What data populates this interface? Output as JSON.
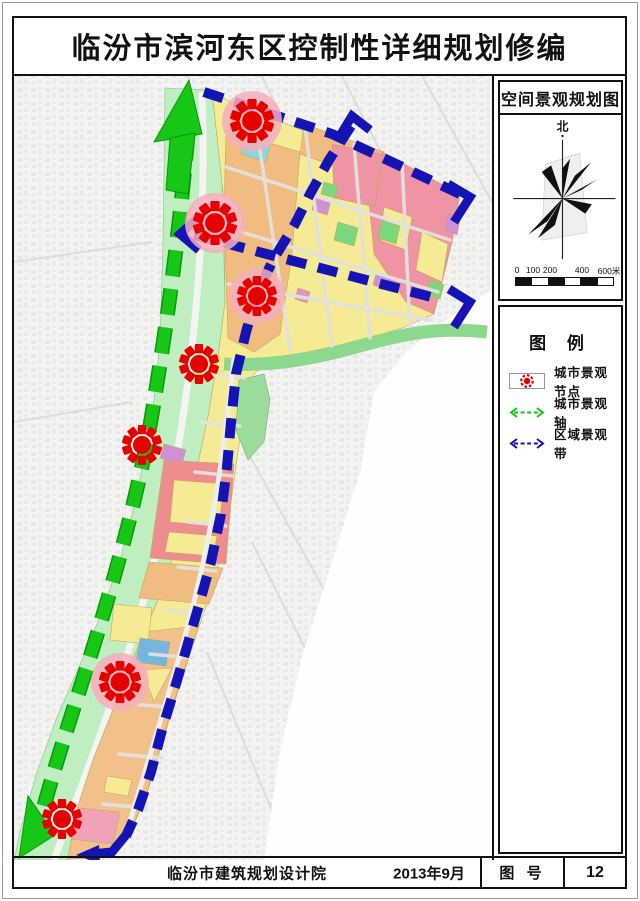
{
  "title": "临汾市滨河东区控制性详细规划修编",
  "panel": {
    "map_title": "空间景观规划图",
    "compass_label": "北",
    "scale_labels": [
      "0",
      "100",
      "200",
      "400",
      "600米"
    ],
    "legend": {
      "title": "图 例",
      "items": [
        {
          "label": "城市景观节点",
          "type": "node-icon",
          "color": "#e60000"
        },
        {
          "label": "城市景观轴",
          "type": "axis-icon",
          "color": "#16c716"
        },
        {
          "label": "区域景观带",
          "type": "belt-icon",
          "color": "#1414b4"
        }
      ]
    }
  },
  "footer": {
    "institute": "临汾市建筑规划设计院",
    "date": "2013年9月",
    "sheet_label": "图 号",
    "sheet_number": "12"
  },
  "map": {
    "axis": {
      "name": "城市景观轴",
      "color": "#16c716",
      "outline": "#0a970a",
      "path": "M186,132 C176,240 168,300 152,400 C138,488 112,580 84,668 C62,736 48,780 38,820",
      "arrow_head_top": "187,78 152,140 200,132",
      "arrow_body_top": "168,136 193,131 186,192 164,188",
      "arrow_head_bottom": "17,856 53,833 26,794"
    },
    "belt_color": "#1414b4",
    "belts": [
      {
        "name": "north-belt",
        "path": "M202,90 L330,132 L458,192",
        "ends": [
          "M336,137 L350,114 L368,128",
          "M446,182 L468,195 L452,220"
        ]
      },
      {
        "name": "east-belt",
        "path": "M349,124 L327,158 L308,192 L293,222 L271,258 L255,292 L244,330 L234,372 L229,420 L225,465 L219,512 L209,560 L197,603 L184,648 L171,692 L160,728 L149,770 L136,808 L124,834",
        "ends": [
          "M124,833 L110,850 L90,852"
        ],
        "tips": [
          "97,843 74,853 98,862"
        ]
      },
      {
        "name": "middle-belt",
        "path": "M192,233 L437,297",
        "ends": [
          "M196,216 L178,232 L197,248",
          "M447,287 L468,300 L452,325"
        ]
      }
    ],
    "nodes": {
      "name": "城市景观节点",
      "color": "#e60000",
      "halo_color": "#f4aebc",
      "points": [
        {
          "x": 250,
          "y": 119,
          "r": 22,
          "halo": true
        },
        {
          "x": 213,
          "y": 221,
          "r": 22,
          "halo": true
        },
        {
          "x": 255,
          "y": 294,
          "r": 20,
          "halo": true
        },
        {
          "x": 197,
          "y": 362,
          "r": 20,
          "halo": false
        },
        {
          "x": 140,
          "y": 443,
          "r": 20,
          "halo": false
        },
        {
          "x": 118,
          "y": 680,
          "r": 21,
          "halo": true
        },
        {
          "x": 60,
          "y": 817,
          "r": 20,
          "halo": false
        }
      ]
    }
  }
}
